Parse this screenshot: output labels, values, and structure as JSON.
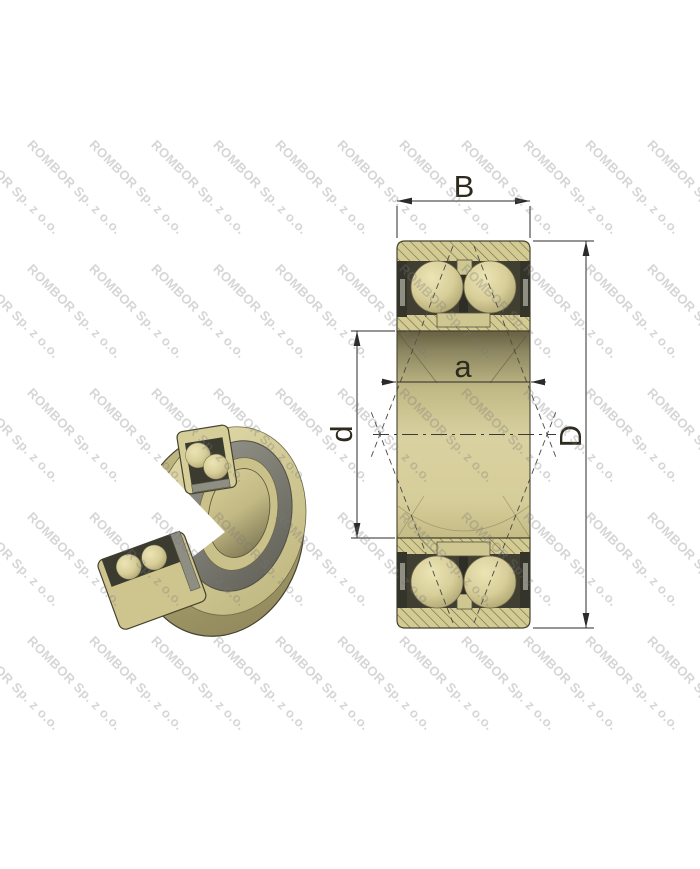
{
  "watermark": {
    "text": "ROMBOR Sp. z o.o."
  },
  "dimensions": {
    "width_label": "B",
    "contact_span_label": "a",
    "bore_diameter_label": "d",
    "outer_diameter_label": "D"
  },
  "colors": {
    "brass_ring": "#d3cb92",
    "hatch_line": "#6d674e",
    "cage_dark": "#403f31",
    "seal_gray": "#8f8e83",
    "outline": "#45432f",
    "dimension_line": "#2b2b2b",
    "watermark_gray": "#d9d9d9"
  }
}
